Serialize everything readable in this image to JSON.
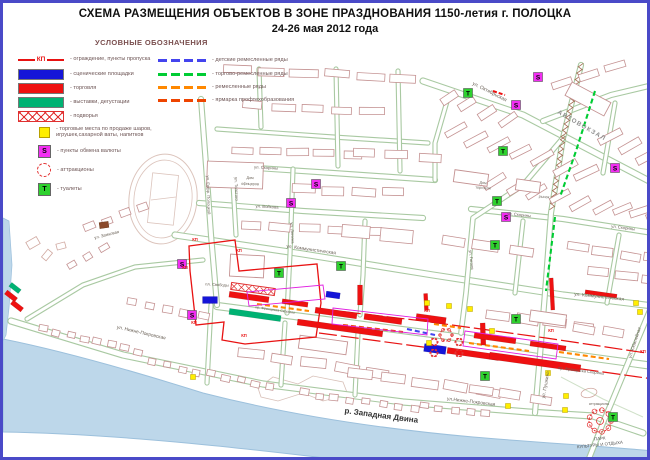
{
  "title": {
    "line1": "СХЕМА РАЗМЕЩЕНИЯ ОБЪЕКТОВ В ЗОНЕ ПРАЗДНОВАНИЯ 1150-летия г. ПОЛОЦКА",
    "line2": "24-26 мая 2012 года"
  },
  "legend": {
    "header": "УСЛОВНЫЕ ОБОЗНАЧЕНИЯ",
    "left": [
      {
        "symbol": "checkpoint-line",
        "kp": "КП",
        "label": "- ограждение, пункты пропуска"
      },
      {
        "symbol": "stage",
        "label": "- сценические площадки"
      },
      {
        "symbol": "trade",
        "label": "- торговля"
      },
      {
        "symbol": "exhibition",
        "label": "- выставки, дегустации"
      },
      {
        "symbol": "farmstead",
        "label": "- подворья"
      },
      {
        "symbol": "kiosk",
        "label": "- торговые места по продаже шаров, игрушек,сахарной ваты, напитков"
      },
      {
        "symbol": "currency-exchange",
        "letter": "S",
        "label": "- пункты обмена валюты"
      },
      {
        "symbol": "attractions",
        "label": "- аттракционы"
      },
      {
        "symbol": "toilet",
        "letter": "Т",
        "label": "- туалеты"
      }
    ],
    "right": [
      {
        "symbol": "children-craft-row",
        "label": "- детские ремесленные ряды"
      },
      {
        "symbol": "trade-craft-row",
        "label": "- торгово-ремесленные ряды"
      },
      {
        "symbol": "craft-row",
        "label": "- ремесленные ряды"
      },
      {
        "symbol": "vocational-fair-row",
        "label": "- ярмарка профтехобразования"
      }
    ]
  },
  "map": {
    "checkpoint_label": "КП",
    "river_label": "р. Западная Двина",
    "street_labels": [
      "ул. Октябрьская",
      "ул. Скорины",
      "ул. Скорины",
      "ул. Скорины",
      "ул. Войкова",
      "ул. Коммунистическая",
      "ул. Коммунистическая",
      "ул. Ленина",
      "ул. Толстого",
      "ул. Евфр. Полоцкой",
      "ул. Гоголя",
      "ул. Пушкина",
      "ул. Нижне-Покровская",
      "ул.Нижне-Покровская",
      "ул. Замковая",
      "пр. Франциска Скорины",
      "пр. Франциска Скорины",
      "ул. Юбилейная"
    ],
    "place_labels": [
      "АВТОВОКЗАЛ",
      "Дом",
      "офицеров",
      "Дом",
      "торговли",
      "рынок",
      "пл. Свободы",
      "аттракционы",
      "ПАРК",
      "КУЛЬТУРЫ И ОТДЫХА"
    ]
  },
  "colors": {
    "frame": "#4a4ac8",
    "fence": "#e81212",
    "stage": "#1515d8",
    "trade": "#ee1111",
    "exhibition": "#00b273",
    "farmstead": "#e03030",
    "kiosk": "#ffee00",
    "currency": "#f22ef2",
    "toilet": "#2ed12e",
    "attraction": "#e33333",
    "children_row": "#4444ee",
    "tradecraft_row": "#00cc33",
    "craft_row": "#ff8800",
    "vocational_row": "#ee4400",
    "river": "#bdd7ea",
    "building": "#c49292",
    "street": "#a9c9a2",
    "map_text": "#6b6258"
  }
}
